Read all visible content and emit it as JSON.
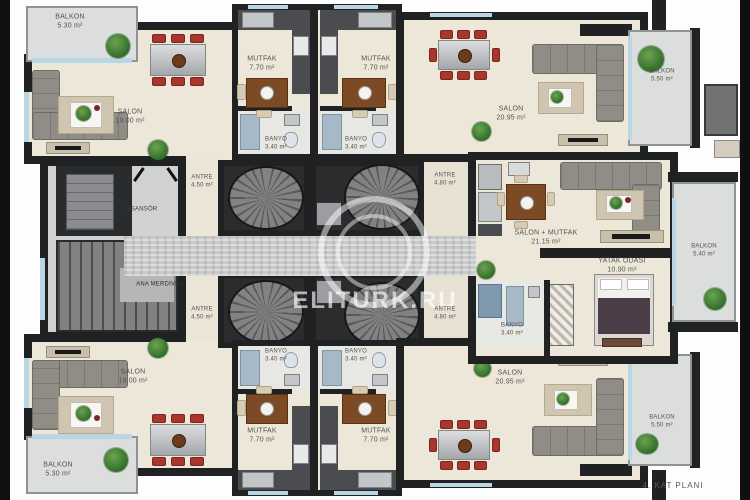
{
  "title": "4. KAT PLANI",
  "watermark": "ELITURK.RU",
  "colors": {
    "wall": "#1f2123",
    "floor": "#ede7da",
    "balcony": "#dcdddd",
    "corridor": "#c8cacc",
    "chair_red": "#a8362c",
    "plant_green": "#2f6b28",
    "window_blue": "#b9d6e4"
  },
  "rooms": {
    "balkon_tl": {
      "name": "BALKON",
      "area": "5.30 m²"
    },
    "salon_tl": {
      "name": "SALON",
      "area": "19.00 m²"
    },
    "mutfak_t1": {
      "name": "MUTFAK",
      "area": "7.70 m²"
    },
    "mutfak_t2": {
      "name": "MUTFAK",
      "area": "7.70 m²"
    },
    "banyo_t1": {
      "name": "BANYO",
      "area": "3.40 m²"
    },
    "banyo_t2": {
      "name": "BANYO",
      "area": "3.40 m²"
    },
    "antre_tl": {
      "name": "ANTRE",
      "area": "4.50 m²"
    },
    "antre_tr": {
      "name": "ANTRE",
      "area": "4.80 m²"
    },
    "salon_tr": {
      "name": "SALON",
      "area": "20.95 m²"
    },
    "balkon_tr": {
      "name": "BALKON",
      "area": "5.50 m²"
    },
    "asansor": {
      "name": "ASANSÖR",
      "area": ""
    },
    "ana_merdiven": {
      "name": "ANA MERDIVEN",
      "area": ""
    },
    "salon_mutfak": {
      "name": "SALON + MUTFAK",
      "area": "21.15 m²"
    },
    "yatak_odasi": {
      "name": "YATAK ODASI",
      "area": "10.90 m²"
    },
    "banyo_r": {
      "name": "BANYO",
      "area": "3.40 m²"
    },
    "balkon_r": {
      "name": "BALKON",
      "area": "5.40 m²"
    },
    "antre_bl": {
      "name": "ANTRE",
      "area": "4.50 m²"
    },
    "antre_br": {
      "name": "ANTRE",
      "area": "4.80 m²"
    },
    "banyo_b1": {
      "name": "BANYO",
      "area": "3.40 m²"
    },
    "banyo_b2": {
      "name": "BANYO",
      "area": "3.40 m²"
    },
    "mutfak_b1": {
      "name": "MUTFAK",
      "area": "7.70 m²"
    },
    "mutfak_b2": {
      "name": "MUTFAK",
      "area": "7.70 m²"
    },
    "salon_bl": {
      "name": "SALON",
      "area": "19.00 m²"
    },
    "balkon_bl": {
      "name": "BALKON",
      "area": "5.30 m²"
    },
    "salon_br": {
      "name": "SALON",
      "area": "20.95 m²"
    },
    "balkon_br": {
      "name": "BALKON",
      "area": "5.50 m²"
    }
  }
}
